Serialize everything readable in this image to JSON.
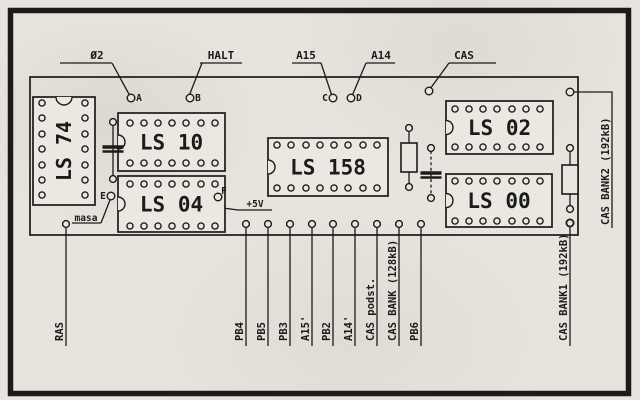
{
  "image_type": "scanned PCB layout diagram (RAM expansion board)",
  "colors": {
    "ink": "#1b1b1b",
    "paper": "#e9e6df",
    "chip_fill": "#ebe8e1"
  },
  "frame": {
    "x": 10.5,
    "y": 10.5,
    "w": 618,
    "h": 383,
    "stroke_width": 5.5
  },
  "board_outline": {
    "x": 30,
    "y": 77,
    "w": 548,
    "h": 158
  },
  "chips": [
    {
      "label": "LS 74",
      "x": 33,
      "y": 97,
      "w": 62,
      "h": 108,
      "orient": "vertical",
      "pin_xs": [
        42,
        85
      ],
      "pin_ys": [
        103,
        118,
        134,
        149,
        165,
        180,
        195
      ],
      "notch": "top"
    },
    {
      "label": "LS 10",
      "x": 118,
      "y": 113,
      "w": 107,
      "h": 58,
      "orient": "horizontal",
      "pin_xs": [
        130,
        144,
        158,
        172,
        186,
        201,
        215
      ],
      "pin_ys": [
        123,
        163
      ],
      "notch": "left"
    },
    {
      "label": "LS 04",
      "x": 118,
      "y": 176,
      "w": 107,
      "h": 56,
      "orient": "horizontal",
      "pin_xs": [
        130,
        144,
        158,
        172,
        186,
        201,
        215
      ],
      "pin_ys": [
        184,
        226
      ],
      "notch": "left"
    },
    {
      "label": "LS 158",
      "x": 268,
      "y": 138,
      "w": 120,
      "h": 58,
      "orient": "horizontal",
      "pin_xs": [
        277,
        291,
        306,
        320,
        334,
        348,
        363,
        377
      ],
      "pin_ys": [
        145,
        188
      ],
      "notch": "left"
    },
    {
      "label": "LS 02",
      "x": 446,
      "y": 101,
      "w": 107,
      "h": 53,
      "orient": "horizontal",
      "pin_xs": [
        455,
        469,
        483,
        497,
        512,
        526,
        540
      ],
      "pin_ys": [
        109,
        147
      ],
      "notch": "left"
    },
    {
      "label": "LS 00",
      "x": 446,
      "y": 174,
      "w": 106,
      "h": 53,
      "orient": "horizontal",
      "pin_xs": [
        455,
        469,
        483,
        497,
        512,
        526,
        540
      ],
      "pin_ys": [
        181,
        221
      ],
      "notch": "left"
    }
  ],
  "top_labels": [
    {
      "text": "Ø2",
      "cx": 97,
      "underline": [
        60,
        112
      ],
      "leader": [
        [
          112,
          63
        ],
        [
          130,
          96
        ]
      ]
    },
    {
      "text": "HALT",
      "cx": 221,
      "underline": [
        200,
        242
      ],
      "leader": [
        [
          202,
          63
        ],
        [
          189,
          96
        ]
      ]
    },
    {
      "text": "A15",
      "cx": 306,
      "underline": [
        292,
        321
      ],
      "leader": [
        [
          321,
          63
        ],
        [
          332,
          96
        ]
      ]
    },
    {
      "text": "A14",
      "cx": 381,
      "underline": [
        366,
        395
      ],
      "leader": [
        [
          366,
          63
        ],
        [
          352,
          96
        ]
      ]
    },
    {
      "text": "CAS",
      "cx": 464,
      "underline": [
        449,
        496
      ],
      "leader": [
        [
          449,
          63
        ],
        [
          430,
          89
        ]
      ]
    }
  ],
  "top_label_baseline_y": 59,
  "top_label_underline_y": 63,
  "test_points": [
    {
      "letter": "A",
      "pad": [
        131,
        98
      ],
      "letter_pos": [
        139,
        101
      ]
    },
    {
      "letter": "B",
      "pad": [
        190,
        98
      ],
      "letter_pos": [
        198,
        101
      ]
    },
    {
      "letter": "C",
      "pad": [
        333,
        98
      ],
      "letter_pos": [
        325,
        101
      ]
    },
    {
      "letter": "D",
      "pad": [
        351,
        98
      ],
      "letter_pos": [
        359,
        101
      ]
    },
    {
      "letter": "E",
      "pad": [
        111,
        196
      ],
      "letter_pos": [
        103,
        199
      ]
    },
    {
      "letter": "F",
      "pad": [
        218,
        197
      ],
      "letter_pos": [
        224,
        194
      ]
    }
  ],
  "bottom_labels": [
    {
      "text": "RAS",
      "x": 66,
      "pad_y": 224
    },
    {
      "text": "PB4",
      "x": 246,
      "pad_y": 224
    },
    {
      "text": "PB5",
      "x": 268,
      "pad_y": 224
    },
    {
      "text": "PB3",
      "x": 290,
      "pad_y": 224
    },
    {
      "text": "A15'",
      "x": 312,
      "pad_y": 224
    },
    {
      "text": "PB2",
      "x": 333,
      "pad_y": 224
    },
    {
      "text": "A14'",
      "x": 355,
      "pad_y": 224
    },
    {
      "text": "CAS podst.",
      "x": 377,
      "pad_y": 224
    },
    {
      "text": "CAS BANK (128kB)",
      "x": 399,
      "pad_y": 224
    },
    {
      "text": "PB6",
      "x": 421,
      "pad_y": 224
    },
    {
      "text": "CAS BANK1 (192kB)",
      "x": 570,
      "pad_y": 223
    }
  ],
  "bottom_label_line_end_y": 346,
  "bottom_label_text_bottom_y": 341,
  "right_label": {
    "text": "CAS BANK2 (192kB)",
    "polyline": [
      [
        574,
        92
      ],
      [
        612,
        92
      ],
      [
        612,
        228
      ]
    ],
    "anchor": [
      609,
      225
    ]
  },
  "ground_label": {
    "text": "masa",
    "cx": 86,
    "baseline_y": 221,
    "underline": [
      72,
      101,
      223
    ],
    "leader": [
      [
        101,
        223
      ],
      [
        110,
        200
      ]
    ]
  },
  "power_label": {
    "text": "+5V",
    "cx": 255,
    "baseline_y": 207,
    "underline": [
      238,
      272,
      210
    ],
    "leader": [
      [
        218,
        201
      ],
      [
        223,
        208
      ],
      [
        238,
        210
      ]
    ]
  },
  "resistors": [
    {
      "name": "resistor-1",
      "cx": 409,
      "pad_top_y": 128,
      "pad_bottom_y": 187,
      "body": [
        401,
        143,
        16,
        29
      ]
    },
    {
      "name": "resistor-2",
      "cx": 570,
      "pad_top_y": 148,
      "pad_bottom_y": 209,
      "body": [
        562,
        165,
        16,
        29
      ]
    }
  ],
  "capacitors": [
    {
      "name": "capacitor-1",
      "x": 113,
      "pad_top_y": 122,
      "pad_bottom_y": 179,
      "plate_ys": [
        147,
        151.5
      ],
      "dashed": false
    },
    {
      "name": "capacitor-2",
      "x": 431,
      "pad_top_y": 148,
      "pad_bottom_y": 198,
      "plate_ys": [
        173,
        177.5
      ],
      "dashed": true
    }
  ],
  "free_pads": [
    {
      "name": "cas-pad",
      "x": 429,
      "y": 91
    },
    {
      "name": "top-right-pad",
      "x": 570,
      "y": 92
    },
    {
      "name": "cas-bank1-pad",
      "x": 570,
      "y": 223
    }
  ]
}
